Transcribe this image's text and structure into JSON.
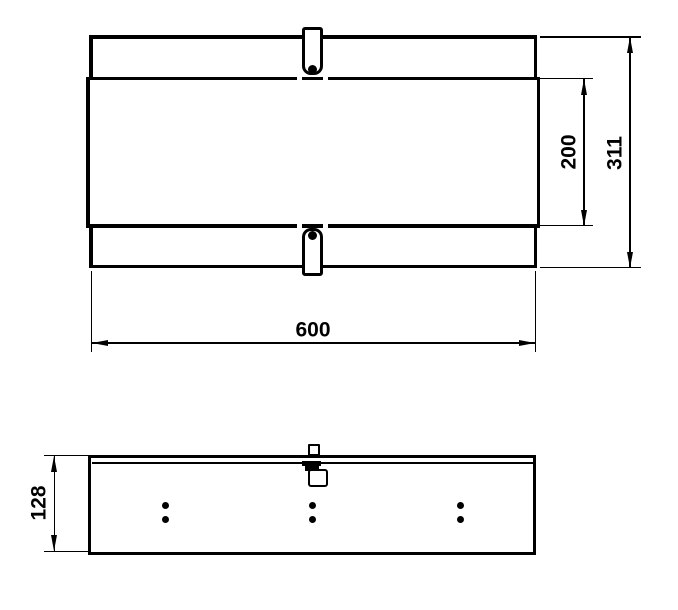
{
  "drawing": {
    "kind": "technical-drawing",
    "colors": {
      "line": "#000000",
      "background": "#ffffff"
    },
    "top_view": {
      "width_label": "600",
      "overall_height_label": "311",
      "inner_height_label": "200"
    },
    "side_view": {
      "height_label": "128"
    }
  }
}
